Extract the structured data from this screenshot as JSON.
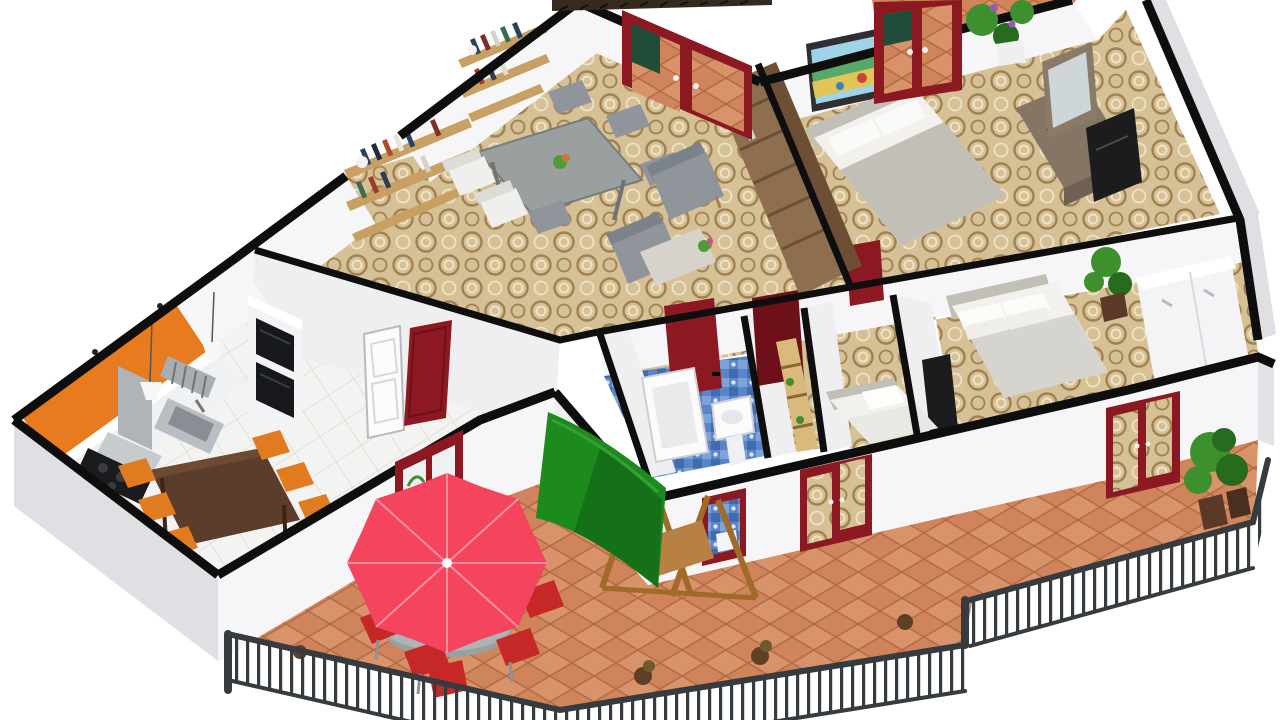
{
  "scene": {
    "title": "3D apartment floor plan, isometric render",
    "view": "cutaway axonometric",
    "background": "#ffffff"
  },
  "colors": {
    "wallCap": "#0e0e0e",
    "wallFace": "#f6f6f8",
    "wallFaceShade": "#efeff2",
    "wallFaceDark": "#e2e2e7",
    "wallExtGray": "#dfdfe4",
    "carpetBase": "#d6c096",
    "carpetRing": "#a08252",
    "carpetRingLight": "#efe3c6",
    "kitchenTile": "#f3f3f1",
    "kitchenGrout": "#dbdbd6",
    "terracotta": "#d0845c",
    "terracottaLight": "#d9936a",
    "terracottaLine": "#b56c45",
    "bathBase": "#5b86c5",
    "bathLight": "#7da3d8",
    "bathDark": "#3f6cb0",
    "accentOrange": "#e87a1f",
    "doorRed": "#8c1822",
    "doorRedDark": "#6e1019",
    "umbrella": "#f4445e",
    "umbrellaRib": "#ff8ea0",
    "swingGreen": "#1d8a1d",
    "swingGreenDark": "#0f5c12",
    "woodLight": "#d9b97c",
    "woodMid": "#a06a28",
    "woodShelf": "#c9a063",
    "bookcase": "#8d6e4e",
    "bookcaseDark": "#6d4f35",
    "tableBrown": "#5a3d2b",
    "chairOrange": "#e07b20",
    "fence": "#363b40",
    "grayTable": "#9aa0a0",
    "grayChair": "#8f959b",
    "bedWhite": "#f2f1ee",
    "bedGray": "#c2bfb7",
    "blanket": "#d6d4cf",
    "plantGreen": "#3e8f2e",
    "plantDark": "#276b1f",
    "artBlack": "#1c1c1e",
    "mirrorGlass": "#cfd6d8",
    "counterWhite": "#f0f1f3",
    "steel": "#aeb4b8",
    "shingle": "#352a1d",
    "redChair": "#c62828"
  },
  "rooms": [
    {
      "id": "living-dining",
      "label": "Living / dining room",
      "floor": "beige swirl carpet"
    },
    {
      "id": "kitchen",
      "label": "Kitchen",
      "floor": "white tile"
    },
    {
      "id": "master-bedroom",
      "label": "Master bedroom",
      "floor": "beige swirl carpet"
    },
    {
      "id": "bedroom-2",
      "label": "Second bedroom",
      "floor": "beige swirl carpet"
    },
    {
      "id": "small-bedroom",
      "label": "Small bedroom",
      "floor": "beige swirl carpet"
    },
    {
      "id": "bathroom",
      "label": "Bathroom",
      "floor": "blue mosaic tile"
    },
    {
      "id": "hallway",
      "label": "Hallway",
      "floor": "beige swirl carpet"
    },
    {
      "id": "terrace",
      "label": "Terrace",
      "floor": "terracotta tile"
    },
    {
      "id": "balcony",
      "label": "Balcony",
      "floor": "terracotta tile"
    }
  ],
  "furniture": {
    "living": [
      "gray dining table",
      "white and gray chairs",
      "wall bookshelves with books",
      "tall wooden bookcase",
      "gray armchairs",
      "console with flowers",
      "red entry french door"
    ],
    "kitchen": [
      "orange backsplash wall",
      "range hood",
      "black cooktop",
      "steel sink",
      "double oven column",
      "white counters",
      "pendant lamps",
      "dark wood table",
      "orange chairs"
    ],
    "master": [
      "double bed with gray blanket",
      "dresser",
      "mirror",
      "landscape painting",
      "black canvas",
      "red balcony french door",
      "potted plants"
    ],
    "bedroom2": [
      "double bed",
      "white wardrobe",
      "potted plant",
      "black canvas"
    ],
    "smallBedroom": [
      "single bed with pillow"
    ],
    "bathroom": [
      "bathtub",
      "pedestal sink",
      "red window"
    ],
    "hallway": [
      "wooden coat rack",
      "red interior doors",
      "white door"
    ],
    "terrace": [
      "red parasol",
      "round patio table",
      "red folding chairs",
      "green swing seat",
      "dark metal railing",
      "potted plants"
    ]
  }
}
